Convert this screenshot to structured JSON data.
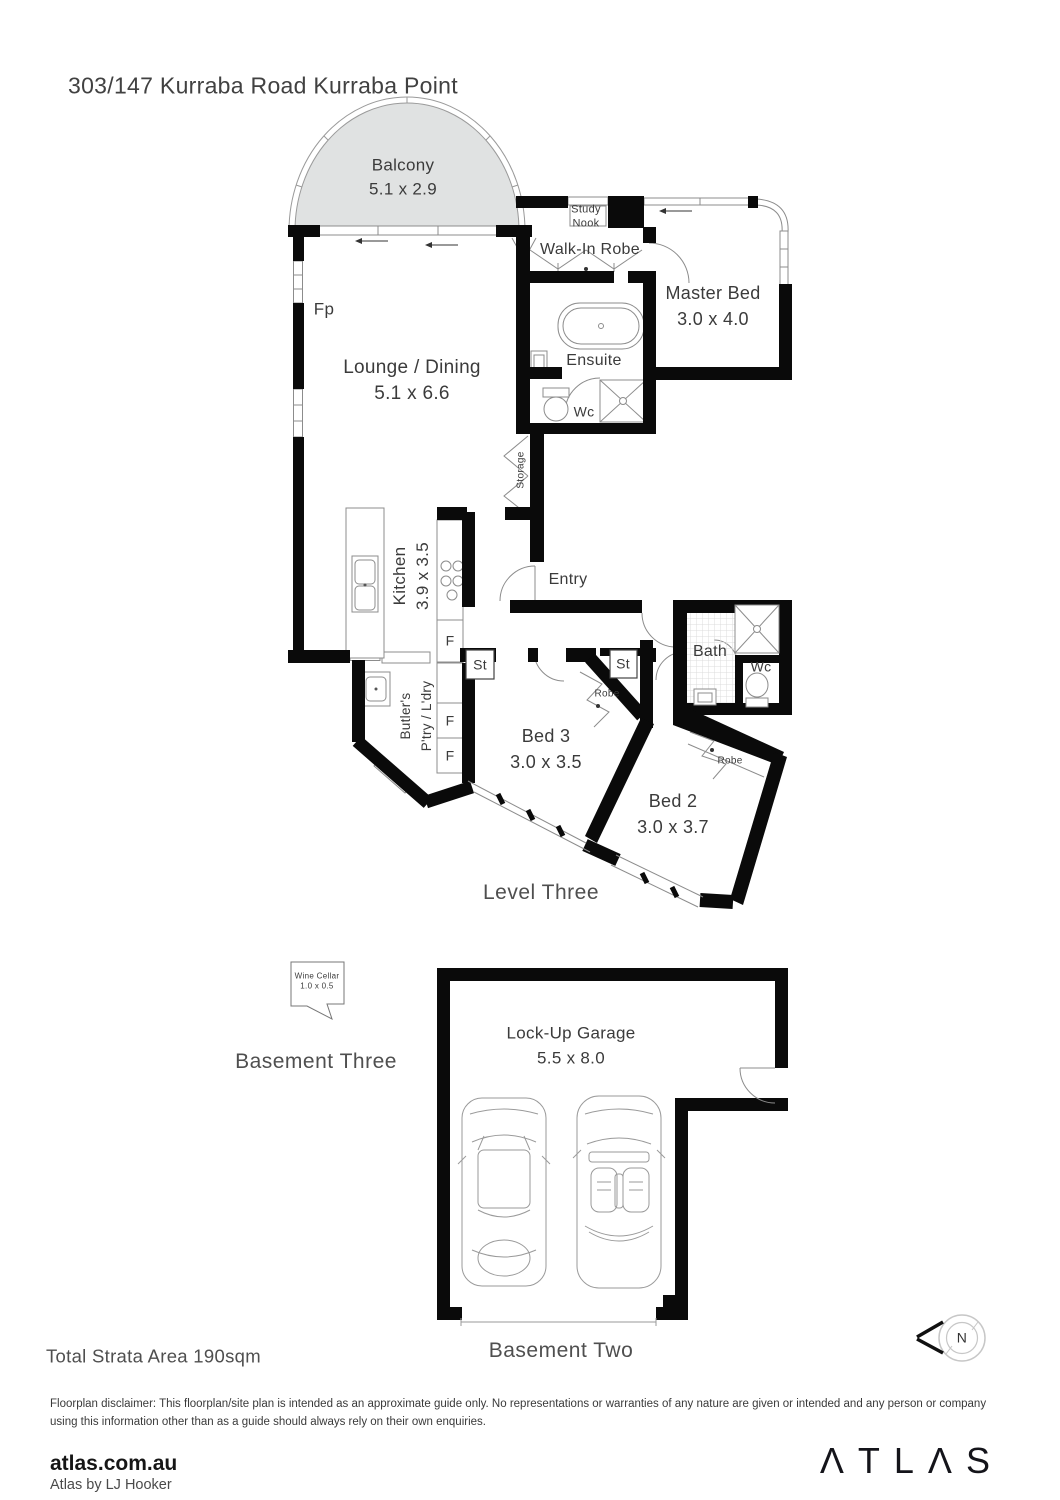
{
  "title": "303/147 Kurraba Road Kurraba Point",
  "colors": {
    "wall": "#0a0a0a",
    "balcony_fill": "#e0e2e2",
    "thin_line": "#8c8c8c",
    "label": "#3b3b3b"
  },
  "level_three": {
    "heading": "Level Three",
    "rooms": {
      "balcony": {
        "name": "Balcony",
        "dims": "5.1 x 2.9"
      },
      "lounge": {
        "name": "Lounge / Dining",
        "dims": "5.1 x 6.6"
      },
      "fireplace": "Fp",
      "study_nook": {
        "line1": "Study",
        "line2": "Nook"
      },
      "walk_in_robe": "Walk-In Robe",
      "master_bed": {
        "name": "Master Bed",
        "dims": "3.0 x 4.0"
      },
      "ensuite": "Ensuite",
      "ensuite_wc": "Wc",
      "storage": "Storage",
      "kitchen": {
        "name": "Kitchen",
        "dims": "3.9 x 3.5"
      },
      "entry": "Entry",
      "fridge1": "F",
      "fridge2": "F",
      "fridge3": "F",
      "store1": "St",
      "store2": "St",
      "bath": "Bath",
      "bath_wc": "Wc",
      "butlers": {
        "line1": "Butler's",
        "line2": "P'try / L'dry"
      },
      "bed3": {
        "name": "Bed 3",
        "dims": "3.0 x 3.5"
      },
      "robe_bed3": "Robe",
      "bed2": {
        "name": "Bed 2",
        "dims": "3.0 x 3.7"
      },
      "robe_bed2": "Robe"
    }
  },
  "basement_three": {
    "heading": "Basement Three",
    "wine_cellar": {
      "name": "Wine Cellar",
      "dims": "1.0 x 0.5"
    }
  },
  "basement_two": {
    "heading": "Basement Two",
    "garage": {
      "name": "Lock-Up Garage",
      "dims": "5.5 x 8.0"
    }
  },
  "summary": {
    "total_area": "Total Strata Area 190sqm"
  },
  "compass": {
    "label": "N"
  },
  "disclaimer": "Floorplan disclaimer: This floorplan/site plan is intended as an approximate guide only. No representations or warranties of any nature are given or intended and any person or company using this information other than as a guide should always rely on their own enquiries.",
  "footer": {
    "website": "atlas.com.au",
    "tagline": "Atlas by LJ Hooker",
    "logo": "ΛTLΛS"
  }
}
